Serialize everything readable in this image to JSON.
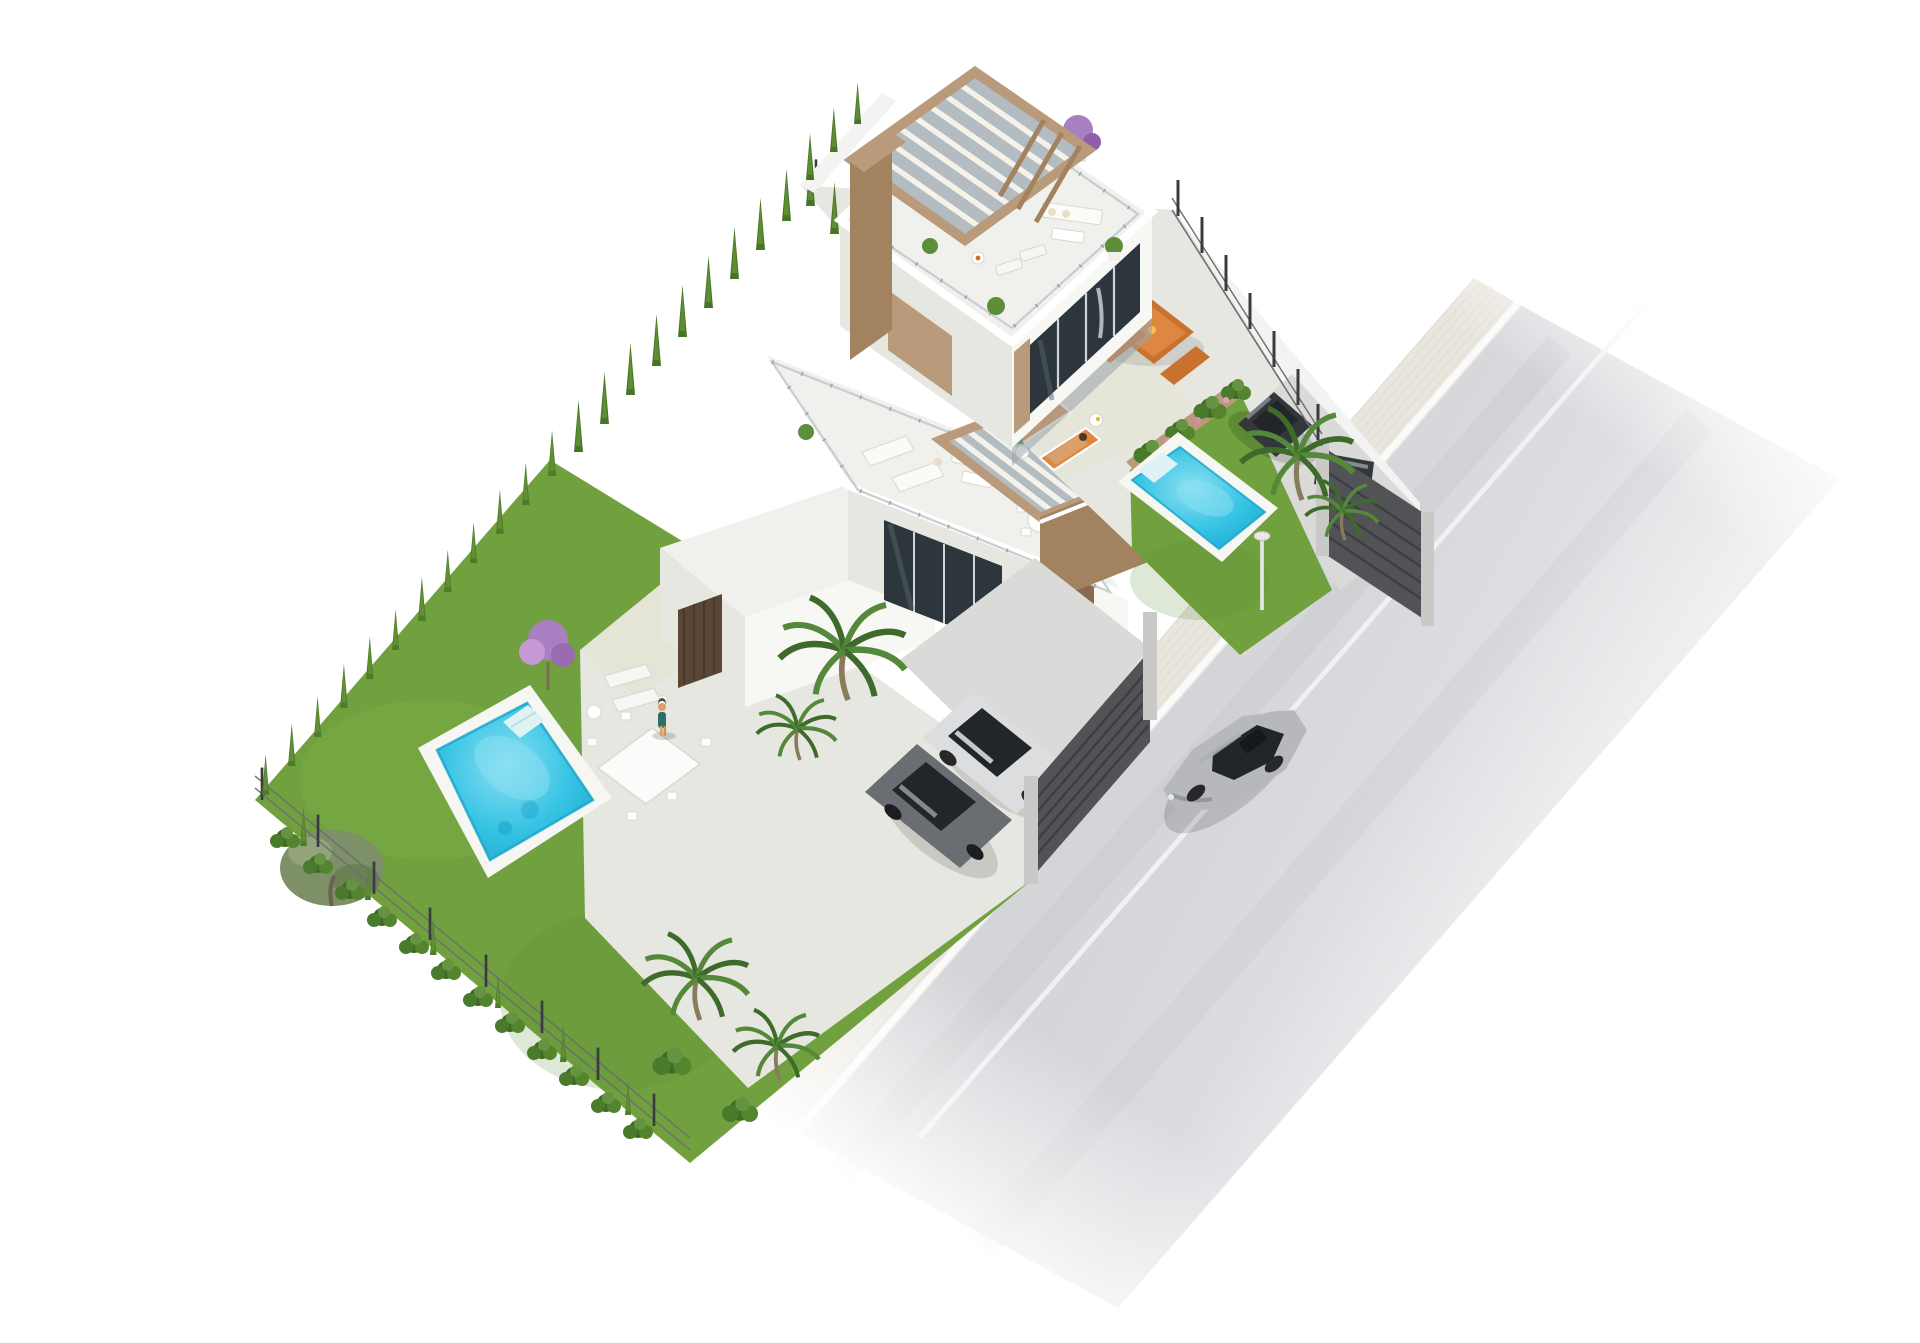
{
  "scene": {
    "kind": "architectural-3d-site-render",
    "background": "#ffffff",
    "plots": 2,
    "villas": 2,
    "swimming_pools": 2,
    "pergolas": 2,
    "parked_cars": 3,
    "moving_cars": 1,
    "people": 2,
    "street_lamps": 1
  },
  "colors": {
    "bg": "#ffffff",
    "patio": "#e7e7e2",
    "patio_shade": "#d8d8d3",
    "terrace": "#f0f0ec",
    "wall_white": "#f7f7f4",
    "wall_shade": "#e7e7e2",
    "fascia": "#ffffff",
    "wood": "#b99b7c",
    "wood_dark": "#a3835f",
    "wood_door": "#8a6a4e",
    "wood_slat_dark": "#5a4634",
    "glass_dark": "#2c363c",
    "glass_frame": "#c5ced2",
    "pergola_shade": "#b3bcc0",
    "grass": "#71a13e",
    "grass_light": "#8fbc57",
    "grass_dark": "#5c8c33",
    "cypress": "#4e7d2a",
    "cypress_light": "#69973a",
    "shrub": "#3f6b26",
    "olive": "#7e9068",
    "purple": "#a87fc0",
    "purple_light": "#c59ad2",
    "pool_aqua": "#36c3e4",
    "pool_light": "#8ce0f2",
    "pool_deep": "#17a0c9",
    "pool_border": "#f6f6f3",
    "road": "#d6d7da",
    "road_line": "#fafafa",
    "sidewalk": "#e9e6de",
    "plinth": "#f3f3f1",
    "fence_dark": "#4c4e52",
    "gate": "#515357",
    "post": "#3a3c40",
    "concrete": "#c9c9c7",
    "gravel": "#dadad8",
    "car_dark": "#33363b",
    "car_grey": "#6a6d71",
    "car_white": "#dcdddf",
    "car_silver": "#b6b8bb",
    "car_glass": "#22262a",
    "orange": "#c9722f",
    "orange_light": "#dd8743",
    "cushion": "#e9dfc9",
    "skin": "#d9a06a",
    "teal": "#2e6e68",
    "shadow": "#000000"
  },
  "objects": {
    "road": {
      "name": "street",
      "lanes_marked": 2,
      "markings": [
        "edge-line",
        "lane-line"
      ]
    },
    "sidewalk": {
      "name": "ribbed-sidewalk"
    },
    "villa_top": {
      "name": "villa-a",
      "features": [
        "roof-terrace",
        "wood-pergola",
        "glass-railing",
        "round-dining-table",
        "outdoor-sofa",
        "sun-loungers",
        "bougainvillea-pot"
      ]
    },
    "villa_middle": {
      "name": "villa-b",
      "features": [
        "roof-terrace",
        "wood-pergola",
        "glass-railing",
        "sun-loungers",
        "outdoor-sofa",
        "round-dining-table"
      ]
    },
    "pool_top": {
      "name": "pool-a",
      "water": "#36c3e4",
      "deck": "#f6f6f3"
    },
    "pool_bottom": {
      "name": "pool-b",
      "water": "#36c3e4",
      "deck": "#f6f6f3"
    },
    "cars": {
      "parked_dark_suv": "#33363b",
      "parked_grey_hatchback": "#6a6d71",
      "parked_white_sedan": "#dcdddf",
      "driving_silver_sedan": "#b6b8bb"
    },
    "garden": {
      "hedges": "cypress-rows",
      "trees": [
        "olive",
        "palms",
        "purple-bougainvillea"
      ],
      "lawn": "#71a13e"
    },
    "fences": {
      "street_gates": "dark-slatted",
      "boundary": "thin-metal-posts-on-white-wall"
    }
  }
}
